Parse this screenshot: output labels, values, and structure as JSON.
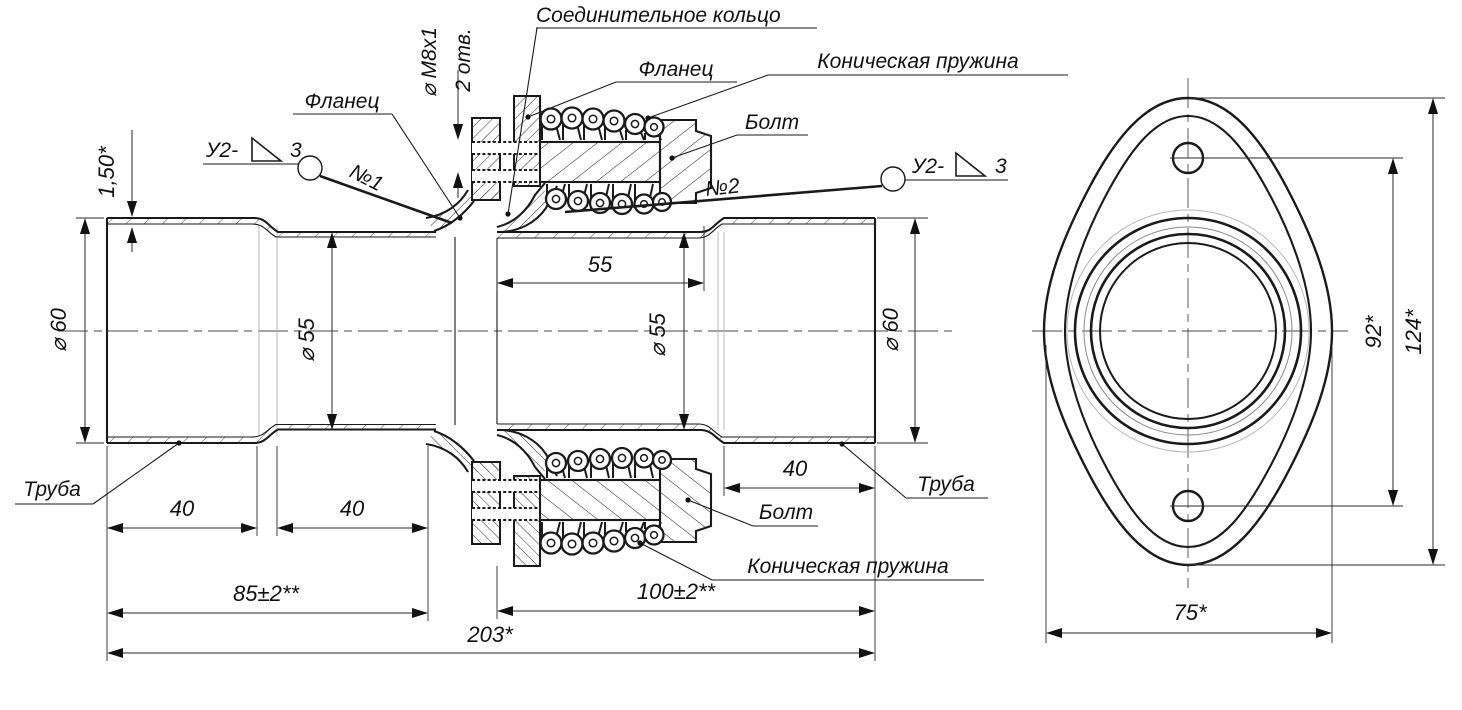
{
  "side_view": {
    "callouts": {
      "connecting_ring": "Соединительное кольцо",
      "flange_top": "Фланец",
      "flange_left": "Фланец",
      "spring_top": "Коническая пружина",
      "spring_bottom": "Коническая пружина",
      "bolt_top": "Болт",
      "bolt_bottom": "Болт",
      "pipe_left": "Труба",
      "pipe_right": "Труба",
      "weld1_tag": "№1",
      "weld2_tag": "№2",
      "weld_code": "У2-",
      "weld_num": "3",
      "thread_dia": "⌀ M8x1",
      "thread_holes": "2 отв."
    },
    "dims": {
      "wall_thickness": "1,50*",
      "dia60_left": "⌀ 60",
      "dia55_mid_left": "⌀ 55",
      "length55": "55",
      "dia55_mid_right": "⌀ 55",
      "dia60_right": "⌀ 60",
      "len40_a": "40",
      "len40_b": "40",
      "len40_c": "40",
      "len85": "85±2**",
      "len100": "100±2**",
      "len203": "203*"
    }
  },
  "front_view": {
    "dims": {
      "holes_span": "92*",
      "height": "124*",
      "width": "75*"
    }
  }
}
